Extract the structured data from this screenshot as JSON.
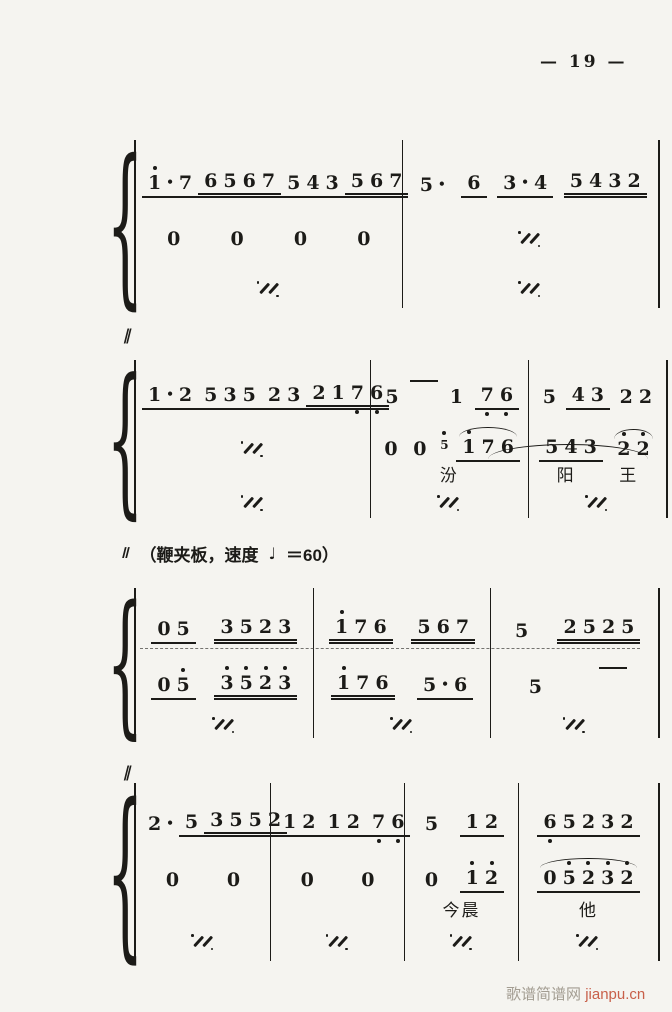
{
  "page": {
    "number": "— 19 —",
    "watermark_site": "歌谱简谱网",
    "watermark_domain": "jianpu.cn"
  },
  "tempo": {
    "mark": "‖",
    "prefix": "（鞭夹板，速度",
    "note_symbol": "♩",
    "suffix": "＝60）"
  },
  "marks": [
    {
      "glyph": "‖",
      "top": 326,
      "left": 124
    },
    {
      "glyph": "‖",
      "top": 763,
      "left": 124
    }
  ],
  "systems": [
    {
      "id": "system-1",
      "top": 140,
      "height": 168,
      "widths": [
        265,
        255
      ],
      "rows_heights": [
        58,
        54,
        50
      ],
      "measures": [
        {
          "rows": [
            [
              {
                "g": [
                  {
                    "n": "1",
                    "hi": 1
                  },
                  "•",
                  "7"
                ],
                "u": 1
              },
              {
                "g": [
                  "6",
                  "5",
                  "6",
                  "7"
                ],
                "u": 2
              },
              {
                "g": [
                  "5",
                  "4",
                  "3"
                ],
                "u": 1
              },
              {
                "g": [
                  "5",
                  "6",
                  "7"
                ],
                "u": 2
              }
            ],
            [
              {
                "g": [
                  "0"
                ]
              },
              {
                "g": [
                  "0"
                ]
              },
              {
                "g": [
                  "0"
                ]
              },
              {
                "g": [
                  "0"
                ]
              }
            ],
            [
              {
                "sim": 1
              }
            ]
          ]
        },
        {
          "rows": [
            [
              {
                "g": [
                  "5",
                  "•"
                ]
              },
              {
                "g": [
                  "6"
                ],
                "u": 1
              },
              {
                "g": [
                  "3",
                  "•",
                  "4"
                ],
                "u": 1
              },
              {
                "g": [
                  "5",
                  "4",
                  "3",
                  "2"
                ],
                "u": 2
              }
            ],
            [
              {
                "sim": 1
              }
            ],
            [
              {
                "sim": 1
              }
            ]
          ]
        }
      ]
    },
    {
      "id": "system-2",
      "top": 360,
      "height": 158,
      "widths": [
        230,
        155,
        135
      ],
      "rows_heights": [
        50,
        52,
        26,
        28
      ],
      "decor": [
        {
          "type": "slur-long",
          "left": 372,
          "top": 84,
          "width": 160,
          "height": 14
        }
      ],
      "measures": [
        {
          "rows": [
            [
              {
                "g": [
                  "1",
                  "•",
                  "2"
                ],
                "u": 1
              },
              {
                "g": [
                  "5",
                  "3",
                  "5"
                ],
                "u": 1
              },
              {
                "g": [
                  "2",
                  "3"
                ],
                "u": 1
              },
              {
                "g": [
                  "2",
                  "1",
                  {
                    "n": "7",
                    "lo": 1
                  },
                  {
                    "n": "6",
                    "lo": 1
                  }
                ],
                "u": 2
              }
            ],
            [
              {
                "sim": 1
              }
            ],
            [],
            [
              {
                "sim": 1
              }
            ]
          ]
        },
        {
          "rows": [
            [
              {
                "g": [
                  "5"
                ]
              },
              {
                "dash": 1
              },
              {
                "g": [
                  "1"
                ]
              },
              {
                "g": [
                  {
                    "n": "7",
                    "lo": 1
                  },
                  {
                    "n": "6",
                    "lo": 1
                  }
                ],
                "u": 1
              }
            ],
            [
              {
                "g": [
                  "0"
                ]
              },
              {
                "g": [
                  "0"
                ]
              },
              {
                "g": [
                  {
                    "n": "5",
                    "hi": 1
                  }
                ],
                "gr": 1
              },
              {
                "g": [
                  {
                    "n": "1",
                    "hi": 1
                  },
                  "7",
                  "6"
                ],
                "u": 1,
                "arc": 1
              }
            ],
            [
              {
                "txt": "汾"
              }
            ],
            [
              {
                "sim": 1
              }
            ]
          ]
        },
        {
          "rows": [
            [
              {
                "g": [
                  "5"
                ]
              },
              {
                "g": [
                  "4",
                  "3"
                ],
                "u": 1
              },
              {
                "g": [
                  "2",
                  "2"
                ]
              }
            ],
            [
              {
                "g": [
                  "5",
                  "4",
                  "3"
                ],
                "u": 1
              },
              {
                "g": [
                  {
                    "n": "2",
                    "hi": 1
                  },
                  {
                    "n": "2",
                    "hi": 1
                  }
                ],
                "arc": 1
              }
            ],
            [
              {
                "txt": "阳"
              },
              {
                "txt": "王"
              }
            ],
            [
              {
                "sim": 1
              }
            ]
          ]
        }
      ]
    },
    {
      "id": "system-3",
      "top": 588,
      "height": 150,
      "widths": [
        175,
        175,
        165
      ],
      "rows_heights": [
        56,
        56,
        38
      ],
      "decor": [
        {
          "type": "dashline",
          "left": 24,
          "top": 60,
          "width": 500
        }
      ],
      "measures": [
        {
          "rows": [
            [
              {
                "g": [
                  "0",
                  "5"
                ],
                "u": 1
              },
              {
                "g": [
                  "3",
                  "5",
                  "2",
                  "3"
                ],
                "u": 2
              }
            ],
            [
              {
                "g": [
                  "0",
                  {
                    "n": "5",
                    "hi": 1
                  }
                ],
                "u": 1
              },
              {
                "g": [
                  {
                    "n": "3",
                    "hi": 1
                  },
                  {
                    "n": "5",
                    "hi": 1
                  },
                  {
                    "n": "2",
                    "hi": 1
                  },
                  {
                    "n": "3",
                    "hi": 1
                  }
                ],
                "u": 2
              }
            ],
            [
              {
                "sim": 1
              }
            ]
          ]
        },
        {
          "rows": [
            [
              {
                "g": [
                  {
                    "n": "1",
                    "hi": 1
                  },
                  "7",
                  "6"
                ],
                "u": 2
              },
              {
                "g": [
                  "5",
                  "6",
                  "7"
                ],
                "u": 2
              }
            ],
            [
              {
                "g": [
                  {
                    "n": "1",
                    "hi": 1
                  },
                  "7",
                  "6"
                ],
                "u": 2
              },
              {
                "g": [
                  "5",
                  "•",
                  "6"
                ],
                "u": 1
              }
            ],
            [
              {
                "sim": 1
              }
            ]
          ]
        },
        {
          "rows": [
            [
              {
                "g": [
                  "5"
                ]
              },
              {
                "g": [
                  "2",
                  "5",
                  "2",
                  "5"
                ],
                "u": 2
              }
            ],
            [
              {
                "g": [
                  "5"
                ]
              },
              {
                "dash": 1
              }
            ],
            [
              {
                "sim": 1
              }
            ]
          ]
        }
      ]
    },
    {
      "id": "system-4",
      "top": 783,
      "height": 178,
      "widths": [
        133,
        132,
        112,
        138
      ],
      "rows_heights": [
        54,
        56,
        30,
        32
      ],
      "measures": [
        {
          "rows": [
            [
              {
                "g": [
                  "2",
                  "•"
                ]
              },
              {
                "g": [
                  "5"
                ],
                "u": 1
              },
              {
                "g": [
                  "3",
                  "5",
                  "5",
                  "2"
                ],
                "u": 2
              }
            ],
            [
              {
                "g": [
                  "0"
                ]
              },
              {
                "g": [
                  "0"
                ]
              }
            ],
            [],
            [
              {
                "sim": 1
              }
            ]
          ]
        },
        {
          "rows": [
            [
              {
                "g": [
                  "1",
                  "2"
                ],
                "u": 1
              },
              {
                "g": [
                  "1",
                  "2"
                ],
                "u": 1
              },
              {
                "g": [
                  {
                    "n": "7",
                    "lo": 1
                  },
                  {
                    "n": "6",
                    "lo": 1
                  }
                ],
                "u": 1
              }
            ],
            [
              {
                "g": [
                  "0"
                ]
              },
              {
                "g": [
                  "0"
                ]
              }
            ],
            [],
            [
              {
                "sim": 1
              }
            ]
          ]
        },
        {
          "rows": [
            [
              {
                "g": [
                  "5"
                ]
              },
              {
                "g": [
                  "1",
                  "2"
                ],
                "u": 1
              }
            ],
            [
              {
                "g": [
                  "0"
                ]
              },
              {
                "g": [
                  {
                    "n": "1",
                    "hi": 1
                  },
                  {
                    "n": "2",
                    "hi": 1
                  }
                ],
                "u": 1
              }
            ],
            [
              {
                "txt": "今晨"
              }
            ],
            [
              {
                "sim": 1
              }
            ]
          ]
        },
        {
          "rows": [
            [
              {
                "g": [
                  {
                    "n": "6",
                    "lo": 1
                  },
                  "5",
                  "2",
                  "3",
                  "2"
                ],
                "u": 1
              }
            ],
            [
              {
                "g": [
                  "0",
                  {
                    "n": "5",
                    "hi": 1
                  },
                  {
                    "n": "2",
                    "hi": 1
                  },
                  {
                    "n": "3",
                    "hi": 1
                  },
                  {
                    "n": "2",
                    "hi": 1
                  }
                ],
                "u": 1,
                "arc": 1
              }
            ],
            [
              {
                "txt": "他"
              }
            ],
            [
              {
                "sim": 1
              }
            ]
          ]
        }
      ]
    }
  ]
}
